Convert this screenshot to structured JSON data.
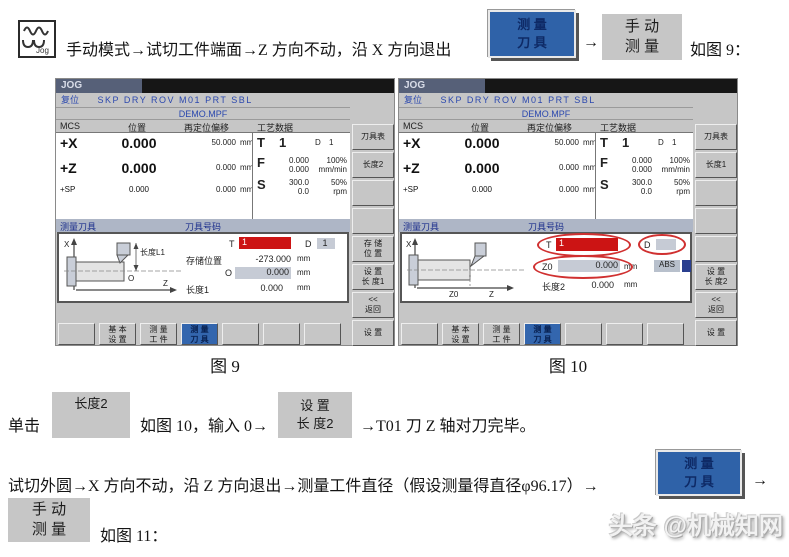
{
  "page": {
    "jog_icon_label": "Jog",
    "line1": {
      "text_before": "手动模式→试切工件端面→Z 方向不动，沿 X 方向退出",
      "btn_measure_tool": "测 量\n刀 具",
      "arrow": "→",
      "btn_manual_measure": "手 动\n测 量",
      "text_after": "如图 9："
    },
    "captions": {
      "fig9": "图 9",
      "fig10": "图 10"
    },
    "line2": {
      "text1": "单击",
      "btn_length2": "长度2",
      "text2": "如图 10，输入 0→",
      "btn_set_length2": "设 置\n长 度2",
      "text3": "→T01 刀 Z 轴对刀完毕。"
    },
    "line3": {
      "text1": "试切外圆→X 方向不动，沿 Z 方向退出→测量工件直径（假设测量得直径φ96.17）→",
      "btn_measure_tool": "测 量\n刀 具",
      "arrow": "→"
    },
    "line4": {
      "btn_manual_measure": "手 动\n测 量",
      "text": "如图 11："
    },
    "watermark": "头条 @机械知网"
  },
  "fig9": {
    "jog_tab": "JOG",
    "status_label": "复位",
    "status_flags": "SKP DRY ROV M01 PRT SBL",
    "program": "DEMO.MPF",
    "col_mcs": "MCS",
    "col_pos": "位置",
    "col_repos": "再定位偏移",
    "col_tech": "工艺数据",
    "axes": {
      "x_name": "+X",
      "x_pos": "0.000",
      "x_repos": "50.000",
      "x_unit": "mm",
      "z_name": "+Z",
      "z_pos": "0.000",
      "z_repos": "0.000",
      "z_unit": "mm",
      "sp_name": "+SP",
      "sp_pos": "0.000",
      "sp_repos": "0.000",
      "sp_unit": "mm"
    },
    "tech": {
      "t_label": "T",
      "t_value": "1",
      "d_label": "D",
      "d_value": "1",
      "f_label": "F",
      "f_act": "0.000",
      "f_set": "0.000",
      "f_ovr": "100%",
      "f_unit": "mm/min",
      "s_label": "S",
      "s_act": "300.0",
      "s_set": "0.0",
      "s_ovr": "50%",
      "s_unit": "rpm"
    },
    "panel": {
      "title": "测量刀具",
      "subtitle": "刀具号码",
      "t_label": "T",
      "t_value": "1",
      "d_label": "D",
      "d_value": "1",
      "storage_label": "存储位置",
      "storage_value": "-273.000",
      "storage_unit": "mm",
      "o_label": "O",
      "o_value": "0.000",
      "o_unit": "mm",
      "length_label": "长度1",
      "length_value": "0.000",
      "length_unit": "mm"
    },
    "diagram": {
      "x_axis": "X",
      "length": "长度L1",
      "origin": "O",
      "z_axis": "Z"
    },
    "softkeys_right": [
      "刀具表",
      "长度2",
      "",
      "",
      "存 储\n位 置",
      "设 置\n长 度1",
      "<<\n返回",
      "设 置"
    ],
    "softkeys_bottom": [
      "",
      "基 本\n设 置",
      "测 量\n工 件",
      "测 量\n刀 具",
      "",
      "",
      ""
    ]
  },
  "fig10": {
    "jog_tab": "JOG",
    "status_label": "复位",
    "status_flags": "SKP DRY ROV M01 PRT SBL",
    "program": "DEMO.MPF",
    "col_mcs": "MCS",
    "col_pos": "位置",
    "col_repos": "再定位偏移",
    "col_tech": "工艺数据",
    "axes": {
      "x_name": "+X",
      "x_pos": "0.000",
      "x_repos": "50.000",
      "x_unit": "mm",
      "z_name": "+Z",
      "z_pos": "0.000",
      "z_repos": "0.000",
      "z_unit": "mm",
      "sp_name": "+SP",
      "sp_pos": "0.000",
      "sp_repos": "0.000",
      "sp_unit": "mm"
    },
    "tech": {
      "t_label": "T",
      "t_value": "1",
      "d_label": "D",
      "d_value": "1",
      "f_label": "F",
      "f_act": "0.000",
      "f_set": "0.000",
      "f_ovr": "100%",
      "f_unit": "mm/min",
      "s_label": "S",
      "s_act": "300.0",
      "s_set": "0.0",
      "s_ovr": "50%",
      "s_unit": "rpm"
    },
    "panel": {
      "title": "测量刀具",
      "subtitle": "刀具号码",
      "t_label": "T",
      "t_value": "1",
      "d_label": "D",
      "d_value": "",
      "z0_label": "Z0",
      "z0_value": "0.000",
      "z0_unit": "mm",
      "abs_label": "ABS",
      "length_label": "长度2",
      "length_value": "0.000",
      "length_unit": "mm"
    },
    "diagram": {
      "x_axis": "X",
      "z0": "Z0",
      "z_axis": "Z"
    },
    "softkeys_right": [
      "刀具表",
      "长度1",
      "",
      "",
      "",
      "设 置\n长 度2",
      "<<\n返回",
      "设 置"
    ],
    "softkeys_bottom": [
      "",
      "基 本\n设 置",
      "测 量\n工 件",
      "测 量\n刀 具",
      "",
      "",
      ""
    ]
  }
}
